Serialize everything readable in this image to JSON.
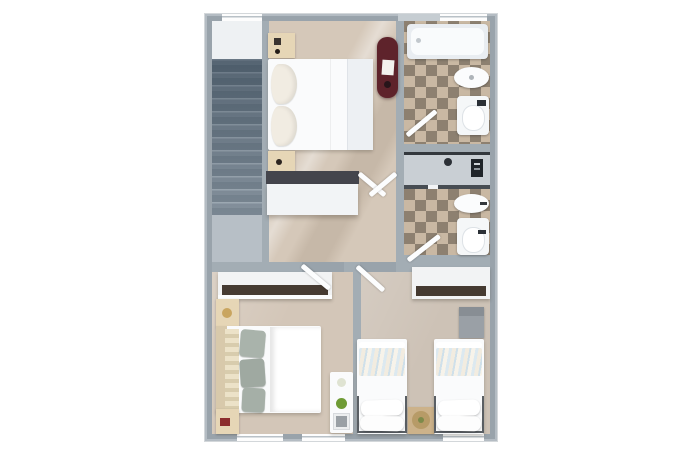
{
  "meta": {
    "kind": "3d-rendered-floor-plan",
    "view": "top-down",
    "text_labels": []
  },
  "palette": {
    "background": "#ffffff",
    "wall": "#99a3ab",
    "wall_inner": "#a3adb4",
    "floor_master_hall": "#d5c8b9",
    "floor_bedroom_left": "#d3c6b8",
    "floor_bedroom_right": "#cdc2b6",
    "tile_light": "#c9b8a3",
    "tile_dark": "#8d8070",
    "stair_landing_top": "#eef1f3",
    "stair_landing_bottom": "#b7bfc6",
    "accent_red_cabinet": "#5e232b",
    "wood_light": "#e6d6b6",
    "wood_headboard": "#d8c9ab",
    "wood_table": "#ccb28a",
    "table_mat": "#b79b67",
    "pillow_sage_1": "#a9b3ab",
    "pillow_sage_2": "#9fa9a1",
    "pillow_sage_3": "#a5afa7",
    "closet_shelf_left": "#463b32",
    "closet_shelf_right": "#453a31",
    "dresser_top": "#44454c",
    "cabinet_gray": "#9aa0a6",
    "cabinet_gray_top": "#888e94",
    "shower_panel": "#1f2429",
    "shower_floor": "#c9cfd4",
    "plant_green": "#6f9b35",
    "lamp_gold": "#c9a55f",
    "book_red": "#8c2d2d"
  },
  "rooms": {
    "staircase": {
      "steps": 12,
      "landings": 2
    },
    "master_bedroom": {
      "furniture": [
        "double-bed",
        "nightstand",
        "nightstand",
        "dresser",
        "red-cabinet"
      ]
    },
    "bathroom_top": {
      "furniture": [
        "bathtub",
        "sink",
        "toilet"
      ],
      "floor": "checker-tile"
    },
    "bathroom_middle": {
      "furniture": [
        "shower",
        "sink",
        "toilet"
      ],
      "floor": "checker-tile"
    },
    "bedroom_left": {
      "furniture": [
        "double-bed",
        "closet",
        "nightstand",
        "nightstand",
        "desk"
      ]
    },
    "bedroom_right": {
      "furniture": [
        "twin-bed",
        "twin-bed",
        "closet",
        "gray-cabinet",
        "bedside-table"
      ]
    }
  },
  "openings": {
    "door_leaves": 6,
    "windows_top": 2,
    "windows_bottom": 3
  }
}
